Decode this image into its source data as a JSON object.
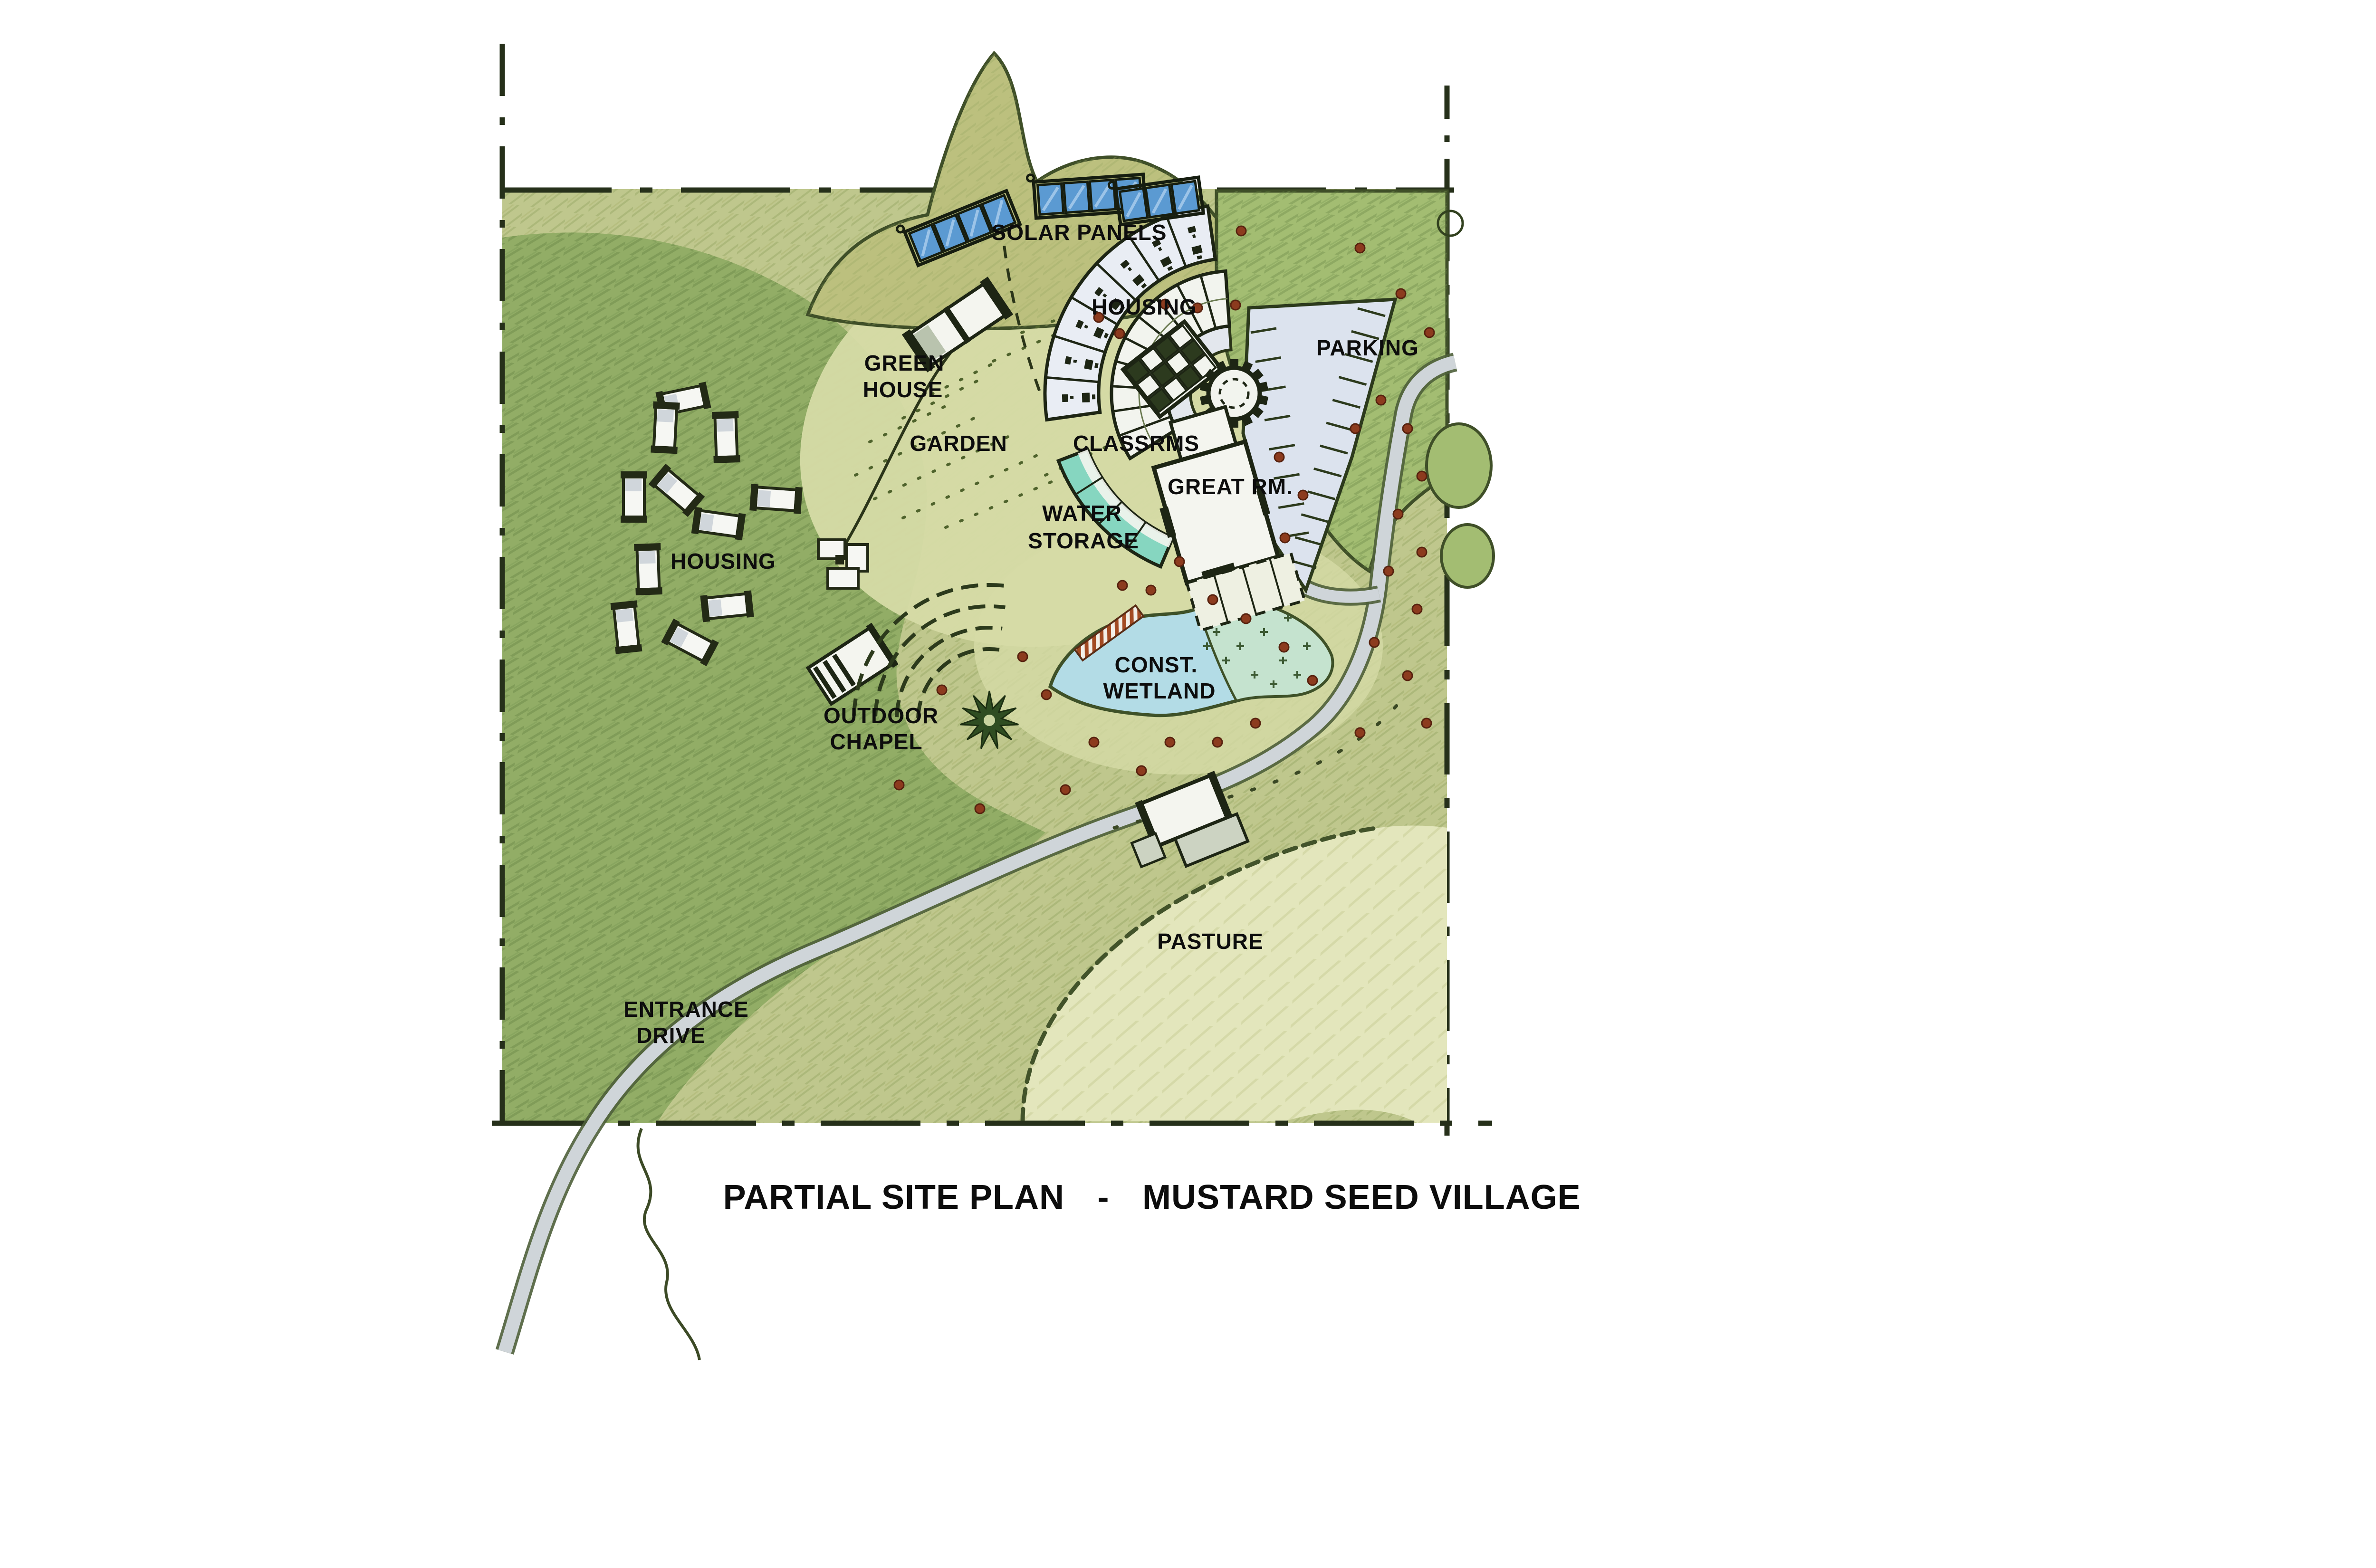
{
  "title": {
    "full": "PARTIAL SITE PLAN - MUSTARD SEED VILLAGE",
    "left": "PARTIAL SITE PLAN",
    "separator": "-",
    "right": "MUSTARD SEED VILLAGE"
  },
  "labels": {
    "solar_panels": "SOLAR PANELS",
    "housing_north": "HOUSING",
    "parking": "PARKING",
    "green_house": {
      "line1": "GREEN",
      "line2": "HOUSE"
    },
    "garden": "GARDEN",
    "classrooms": "CLASSRMS",
    "great_room": "GREAT RM.",
    "water_storage": {
      "line1": "WATER",
      "line2": "STORAGE"
    },
    "housing_west": "HOUSING",
    "constructed_wetland": {
      "line1": "CONST.",
      "line2": "WETLAND"
    },
    "outdoor_chapel": {
      "line1": "OUTDOOR",
      "line2": "CHAPEL"
    },
    "pasture": "PASTURE",
    "entrance_drive": {
      "line1": "ENTRANCE",
      "line2": "DRIVE"
    }
  },
  "colors": {
    "field_green": "#bfc78d",
    "dark_green": "#92ad66",
    "tree_green": "#a3bd72",
    "pale_clearing_green": "#d6dba6",
    "pasture_green": "#e3e6bc",
    "pond_blue": "#b3dce6",
    "marsh_green_blue": "#c5e3cf",
    "water_storage_teal": "#86d6c0",
    "solar_panel_blue": "#5b9ad2",
    "road_grey": "#cfd5d9",
    "parking_grey": "#dce3ee",
    "shrub_red": "#8c3b1e",
    "ink": "#0d0d0d"
  }
}
